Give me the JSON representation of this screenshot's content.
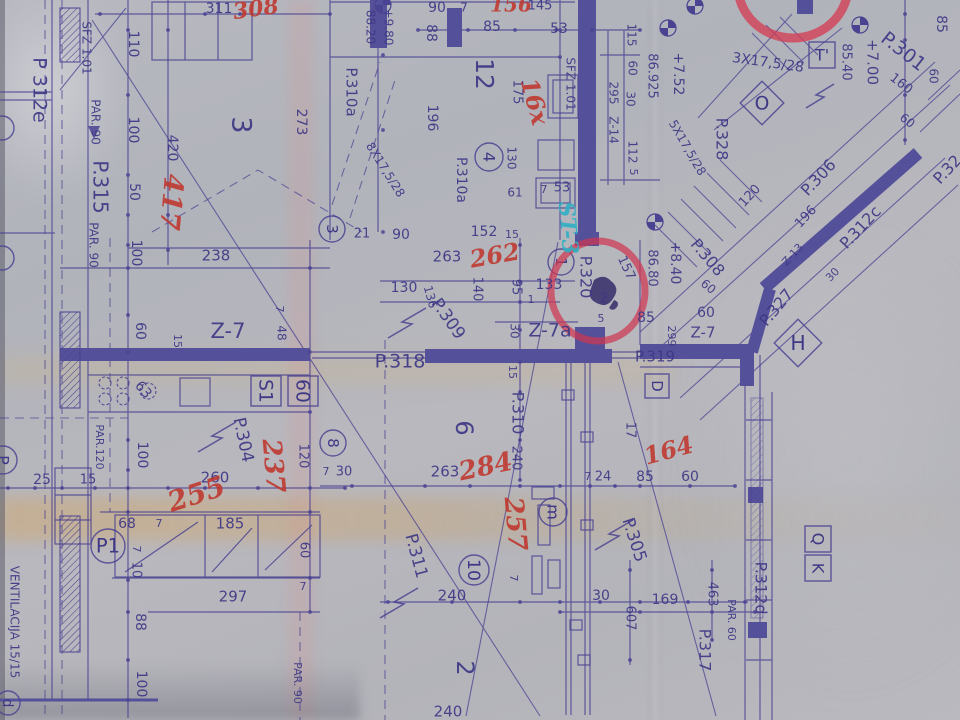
{
  "document": {
    "kind": "architectural floor plan blueprint (photograph)",
    "vent_note": "VENTILACIJA 15/15"
  },
  "colors": {
    "paper": "#b4b5bc",
    "ink": "#4a4392",
    "ink_text": "#3e3886",
    "wall": "#55509a",
    "red_note": "#bf3a31",
    "red_circle": "#cf3752",
    "teal_note": "#2fb0c4",
    "crease_tan": "#c9ab79"
  },
  "labels": [
    {
      "t": "311",
      "x": 219,
      "y": 9,
      "r": 0,
      "s": 14
    },
    {
      "t": "308",
      "x": 256,
      "y": 10,
      "r": -8,
      "s": 22,
      "c": "red",
      "k": "site-note-red"
    },
    {
      "t": "90",
      "x": 437,
      "y": 8,
      "r": 0,
      "s": 14
    },
    {
      "t": "7",
      "x": 464,
      "y": 8,
      "r": 0,
      "s": 12
    },
    {
      "t": "156",
      "x": 511,
      "y": 6,
      "r": 0,
      "s": 20,
      "c": "red",
      "k": "site-note-red"
    },
    {
      "t": "145",
      "x": 540,
      "y": 6,
      "r": 0,
      "s": 13
    },
    {
      "t": "85",
      "x": 492,
      "y": 27,
      "r": 0,
      "s": 14
    },
    {
      "t": "53",
      "x": 559,
      "y": 29,
      "r": 0,
      "s": 14
    },
    {
      "t": "88",
      "x": 431,
      "y": 33,
      "r": 90,
      "s": 14
    },
    {
      "t": "88.20",
      "x": 370,
      "y": 27,
      "r": 90,
      "s": 12
    },
    {
      "t": "+9.80",
      "x": 388,
      "y": 27,
      "r": 90,
      "s": 12
    },
    {
      "t": "110",
      "x": 133,
      "y": 44,
      "r": 90,
      "s": 14
    },
    {
      "t": "100",
      "x": 133,
      "y": 130,
      "r": 90,
      "s": 14
    },
    {
      "t": "50",
      "x": 134,
      "y": 192,
      "r": 90,
      "s": 14
    },
    {
      "t": "420",
      "x": 172,
      "y": 148,
      "r": 90,
      "s": 14
    },
    {
      "t": "417",
      "x": 170,
      "y": 202,
      "r": 95,
      "s": 27,
      "c": "red",
      "k": "site-note-red"
    },
    {
      "t": "SFZ 1.01",
      "x": 86,
      "y": 48,
      "r": 90,
      "s": 12,
      "k": "shaft-label"
    },
    {
      "t": "P 312e",
      "x": 39,
      "y": 90,
      "r": 90,
      "s": 19,
      "k": "door-label"
    },
    {
      "t": "PAR. 90",
      "x": 95,
      "y": 122,
      "r": 90,
      "s": 12,
      "k": "parapet-label"
    },
    {
      "t": "P.315",
      "x": 99,
      "y": 187,
      "r": 90,
      "s": 20,
      "k": "door-label"
    },
    {
      "t": "PAR. 90",
      "x": 93,
      "y": 245,
      "r": 90,
      "s": 12,
      "k": "parapet-label"
    },
    {
      "t": "3",
      "x": 240,
      "y": 125,
      "r": 90,
      "s": 27,
      "k": "room-number"
    },
    {
      "t": "273",
      "x": 301,
      "y": 122,
      "r": 90,
      "s": 14
    },
    {
      "t": "P.310a",
      "x": 351,
      "y": 92,
      "r": 90,
      "s": 15,
      "k": "door-label"
    },
    {
      "t": "12",
      "x": 483,
      "y": 74,
      "r": 90,
      "s": 25,
      "k": "room-number"
    },
    {
      "t": "175",
      "x": 517,
      "y": 92,
      "r": 90,
      "s": 13
    },
    {
      "t": "196",
      "x": 432,
      "y": 118,
      "r": 90,
      "s": 14
    },
    {
      "t": "16x",
      "x": 533,
      "y": 102,
      "r": 75,
      "s": 24,
      "c": "red",
      "k": "site-note-red"
    },
    {
      "t": "SFZ 1.01",
      "x": 570,
      "y": 84,
      "r": 90,
      "s": 12,
      "k": "shaft-label"
    },
    {
      "t": "115",
      "x": 631,
      "y": 35,
      "r": 90,
      "s": 12
    },
    {
      "t": "60",
      "x": 632,
      "y": 68,
      "r": 90,
      "s": 12
    },
    {
      "t": "295",
      "x": 613,
      "y": 93,
      "r": 90,
      "s": 12
    },
    {
      "t": "30",
      "x": 630,
      "y": 99,
      "r": 90,
      "s": 12
    },
    {
      "t": "Z-14",
      "x": 613,
      "y": 130,
      "r": 90,
      "s": 12,
      "k": "lintel-label"
    },
    {
      "t": "112",
      "x": 632,
      "y": 152,
      "r": 90,
      "s": 12
    },
    {
      "t": "5",
      "x": 633,
      "y": 172,
      "r": 90,
      "s": 11
    },
    {
      "t": "86.925",
      "x": 652,
      "y": 76,
      "r": 90,
      "s": 13,
      "k": "elevation"
    },
    {
      "t": "+7.52",
      "x": 678,
      "y": 74,
      "r": 90,
      "s": 14,
      "k": "elevation"
    },
    {
      "t": "85.40",
      "x": 846,
      "y": 62,
      "r": 90,
      "s": 13,
      "k": "elevation"
    },
    {
      "t": "+7.00",
      "x": 872,
      "y": 62,
      "r": 90,
      "s": 15,
      "k": "elevation"
    },
    {
      "t": "P.301",
      "x": 903,
      "y": 52,
      "r": 38,
      "s": 19,
      "k": "door-label"
    },
    {
      "t": "85",
      "x": 941,
      "y": 24,
      "r": 90,
      "s": 14
    },
    {
      "t": "160",
      "x": 901,
      "y": 84,
      "r": 38,
      "s": 13
    },
    {
      "t": "60",
      "x": 933,
      "y": 76,
      "r": 90,
      "s": 12
    },
    {
      "t": "60",
      "x": 907,
      "y": 121,
      "r": 38,
      "s": 12
    },
    {
      "t": "3X17,5/28",
      "x": 768,
      "y": 63,
      "r": 8,
      "s": 14,
      "k": "stair-label"
    },
    {
      "t": "P.328",
      "x": 721,
      "y": 139,
      "r": 90,
      "s": 16,
      "k": "door-label"
    },
    {
      "t": "5X17,5/28",
      "x": 687,
      "y": 148,
      "r": 60,
      "s": 12,
      "k": "stair-label"
    },
    {
      "t": "8X17,5/28",
      "x": 385,
      "y": 170,
      "r": 58,
      "s": 12,
      "k": "stair-label"
    },
    {
      "t": "120",
      "x": 750,
      "y": 196,
      "r": -47,
      "s": 13
    },
    {
      "t": "P.306",
      "x": 819,
      "y": 178,
      "r": -47,
      "s": 16,
      "k": "door-label"
    },
    {
      "t": "196",
      "x": 806,
      "y": 217,
      "r": -47,
      "s": 13
    },
    {
      "t": "P.312c",
      "x": 861,
      "y": 228,
      "r": -47,
      "s": 16,
      "k": "door-label"
    },
    {
      "t": "Z-13",
      "x": 793,
      "y": 255,
      "r": -47,
      "s": 11,
      "k": "lintel-label"
    },
    {
      "t": "30",
      "x": 833,
      "y": 275,
      "r": -47,
      "s": 11
    },
    {
      "t": "P.327",
      "x": 777,
      "y": 308,
      "r": -50,
      "s": 16,
      "k": "door-label"
    },
    {
      "t": "P.32",
      "x": 948,
      "y": 170,
      "r": -47,
      "s": 16,
      "k": "door-label"
    },
    {
      "t": "61",
      "x": 515,
      "y": 193,
      "r": 0,
      "s": 12
    },
    {
      "t": "7",
      "x": 544,
      "y": 190,
      "r": 0,
      "s": 11
    },
    {
      "t": "53",
      "x": 562,
      "y": 188,
      "r": 0,
      "s": 13
    },
    {
      "t": "130",
      "x": 511,
      "y": 158,
      "r": 90,
      "s": 12
    },
    {
      "t": "P.310a",
      "x": 461,
      "y": 180,
      "r": 90,
      "s": 14,
      "k": "door-label"
    },
    {
      "t": "21",
      "x": 362,
      "y": 234,
      "r": 0,
      "s": 13
    },
    {
      "t": "90",
      "x": 401,
      "y": 235,
      "r": 0,
      "s": 14
    },
    {
      "t": "152",
      "x": 484,
      "y": 232,
      "r": 0,
      "s": 14
    },
    {
      "t": "15",
      "x": 512,
      "y": 235,
      "r": 0,
      "s": 11
    },
    {
      "t": "238",
      "x": 216,
      "y": 256,
      "r": 0,
      "s": 15
    },
    {
      "t": "100",
      "x": 136,
      "y": 253,
      "r": 90,
      "s": 14
    },
    {
      "t": "60",
      "x": 140,
      "y": 331,
      "r": 90,
      "s": 14
    },
    {
      "t": "15",
      "x": 177,
      "y": 341,
      "r": 90,
      "s": 11
    },
    {
      "t": "Z-7",
      "x": 228,
      "y": 332,
      "r": 0,
      "s": 21,
      "k": "lintel-label"
    },
    {
      "t": "7",
      "x": 279,
      "y": 309,
      "r": 90,
      "s": 11
    },
    {
      "t": "48",
      "x": 281,
      "y": 333,
      "r": 90,
      "s": 12
    },
    {
      "t": "63",
      "x": 143,
      "y": 390,
      "r": 50,
      "s": 14
    },
    {
      "t": "263",
      "x": 447,
      "y": 257,
      "r": 0,
      "s": 15
    },
    {
      "t": "262",
      "x": 495,
      "y": 257,
      "r": -10,
      "s": 24,
      "c": "red",
      "k": "site-note-red"
    },
    {
      "t": "130",
      "x": 404,
      "y": 288,
      "r": 0,
      "s": 14
    },
    {
      "t": "136",
      "x": 430,
      "y": 297,
      "r": 75,
      "s": 12
    },
    {
      "t": "P.309",
      "x": 448,
      "y": 319,
      "r": 55,
      "s": 17,
      "k": "door-label"
    },
    {
      "t": "140",
      "x": 477,
      "y": 289,
      "r": 90,
      "s": 13
    },
    {
      "t": "95",
      "x": 516,
      "y": 287,
      "r": 90,
      "s": 13
    },
    {
      "t": "1",
      "x": 531,
      "y": 300,
      "r": 0,
      "s": 11
    },
    {
      "t": "133",
      "x": 549,
      "y": 285,
      "r": 0,
      "s": 14
    },
    {
      "t": "30",
      "x": 514,
      "y": 331,
      "r": 90,
      "s": 12
    },
    {
      "t": "Z-7a",
      "x": 550,
      "y": 331,
      "r": 0,
      "s": 19,
      "k": "lintel-label"
    },
    {
      "t": "P.318",
      "x": 400,
      "y": 362,
      "r": 0,
      "s": 19,
      "k": "door-label"
    },
    {
      "t": "P.320",
      "x": 585,
      "y": 277,
      "r": 90,
      "s": 16,
      "k": "door-label"
    },
    {
      "t": "157",
      "x": 626,
      "y": 268,
      "r": 65,
      "s": 13
    },
    {
      "t": "2",
      "x": 604,
      "y": 299,
      "r": 0,
      "s": 13
    },
    {
      "t": "5",
      "x": 601,
      "y": 319,
      "r": 0,
      "s": 11
    },
    {
      "t": "85",
      "x": 646,
      "y": 318,
      "r": 0,
      "s": 14
    },
    {
      "t": "86.80",
      "x": 652,
      "y": 268,
      "r": 90,
      "s": 13,
      "k": "elevation"
    },
    {
      "t": "+8.40",
      "x": 675,
      "y": 263,
      "r": 90,
      "s": 14,
      "k": "elevation"
    },
    {
      "t": "P.308",
      "x": 707,
      "y": 258,
      "r": 50,
      "s": 16,
      "k": "door-label"
    },
    {
      "t": "60",
      "x": 708,
      "y": 287,
      "r": 40,
      "s": 12
    },
    {
      "t": "60",
      "x": 706,
      "y": 313,
      "r": 0,
      "s": 14
    },
    {
      "t": "299",
      "x": 671,
      "y": 336,
      "r": 90,
      "s": 11
    },
    {
      "t": "Z-7",
      "x": 703,
      "y": 333,
      "r": 0,
      "s": 15,
      "k": "lintel-label"
    },
    {
      "t": "P.319",
      "x": 655,
      "y": 357,
      "r": 0,
      "s": 15,
      "k": "door-label"
    },
    {
      "t": "17",
      "x": 630,
      "y": 430,
      "r": 90,
      "s": 13
    },
    {
      "t": "164",
      "x": 669,
      "y": 452,
      "r": -15,
      "s": 24,
      "c": "red",
      "k": "site-note-red"
    },
    {
      "t": "15",
      "x": 512,
      "y": 372,
      "r": 90,
      "s": 11
    },
    {
      "t": "P.310",
      "x": 517,
      "y": 413,
      "r": 90,
      "s": 16,
      "k": "door-label"
    },
    {
      "t": "240",
      "x": 516,
      "y": 458,
      "r": 90,
      "s": 13
    },
    {
      "t": "6",
      "x": 463,
      "y": 428,
      "r": 90,
      "s": 24,
      "k": "room-number"
    },
    {
      "t": "7",
      "x": 326,
      "y": 472,
      "r": 0,
      "s": 11
    },
    {
      "t": "30",
      "x": 344,
      "y": 472,
      "r": 0,
      "s": 13
    },
    {
      "t": "263",
      "x": 445,
      "y": 472,
      "r": 0,
      "s": 15
    },
    {
      "t": "284",
      "x": 486,
      "y": 468,
      "r": -12,
      "s": 26,
      "c": "red",
      "k": "site-note-red"
    },
    {
      "t": "237",
      "x": 272,
      "y": 466,
      "r": 85,
      "s": 26,
      "c": "red",
      "k": "site-note-red"
    },
    {
      "t": "P.304",
      "x": 243,
      "y": 440,
      "r": 78,
      "s": 17,
      "k": "door-label"
    },
    {
      "t": "260",
      "x": 215,
      "y": 478,
      "r": 0,
      "s": 15
    },
    {
      "t": "255",
      "x": 197,
      "y": 496,
      "r": -18,
      "s": 28,
      "c": "red",
      "k": "site-note-red"
    },
    {
      "t": "120",
      "x": 303,
      "y": 456,
      "r": 90,
      "s": 13
    },
    {
      "t": "25",
      "x": 42,
      "y": 480,
      "r": 0,
      "s": 14
    },
    {
      "t": "15",
      "x": 88,
      "y": 480,
      "r": 0,
      "s": 13
    },
    {
      "t": "100",
      "x": 142,
      "y": 455,
      "r": 90,
      "s": 14
    },
    {
      "t": "PAR.120",
      "x": 99,
      "y": 447,
      "r": 90,
      "s": 11,
      "k": "parapet-label"
    },
    {
      "t": "68",
      "x": 127,
      "y": 524,
      "r": 0,
      "s": 14
    },
    {
      "t": "7",
      "x": 159,
      "y": 524,
      "r": 0,
      "s": 11
    },
    {
      "t": "7",
      "x": 136,
      "y": 549,
      "r": 90,
      "s": 11
    },
    {
      "t": "10",
      "x": 136,
      "y": 570,
      "r": 90,
      "s": 13
    },
    {
      "t": "185",
      "x": 230,
      "y": 524,
      "r": 0,
      "s": 15
    },
    {
      "t": "60",
      "x": 304,
      "y": 550,
      "r": 90,
      "s": 13
    },
    {
      "t": "7",
      "x": 303,
      "y": 587,
      "r": 0,
      "s": 11
    },
    {
      "t": "297",
      "x": 233,
      "y": 597,
      "r": 0,
      "s": 15
    },
    {
      "t": "88",
      "x": 140,
      "y": 622,
      "r": 90,
      "s": 14
    },
    {
      "t": "100",
      "x": 141,
      "y": 684,
      "r": 90,
      "s": 14
    },
    {
      "t": "PAR. 90",
      "x": 297,
      "y": 683,
      "r": 90,
      "s": 11,
      "k": "parapet-label"
    },
    {
      "t": "VENTILACIJA 15/15",
      "x": 14,
      "y": 622,
      "r": 90,
      "s": 12,
      "k": "vent-label"
    },
    {
      "t": "257",
      "x": 514,
      "y": 524,
      "r": 85,
      "s": 26,
      "c": "red",
      "k": "site-note-red"
    },
    {
      "t": "240",
      "x": 452,
      "y": 596,
      "r": 0,
      "s": 15
    },
    {
      "t": "P.311",
      "x": 416,
      "y": 556,
      "r": 75,
      "s": 17,
      "k": "door-label"
    },
    {
      "t": "2",
      "x": 464,
      "y": 668,
      "r": 90,
      "s": 24,
      "k": "room-number"
    },
    {
      "t": "240",
      "x": 448,
      "y": 712,
      "r": 0,
      "s": 15
    },
    {
      "t": "30",
      "x": 601,
      "y": 596,
      "r": 0,
      "s": 14
    },
    {
      "t": "607",
      "x": 630,
      "y": 618,
      "r": 90,
      "s": 13
    },
    {
      "t": "169",
      "x": 665,
      "y": 600,
      "r": 0,
      "s": 14
    },
    {
      "t": "463",
      "x": 712,
      "y": 594,
      "r": 90,
      "s": 13
    },
    {
      "t": "PAR. 60",
      "x": 731,
      "y": 620,
      "r": 90,
      "s": 11,
      "k": "parapet-label"
    },
    {
      "t": "P.312d",
      "x": 760,
      "y": 588,
      "r": 90,
      "s": 16,
      "k": "door-label"
    },
    {
      "t": "P.317",
      "x": 704,
      "y": 650,
      "r": 90,
      "s": 16,
      "k": "door-label"
    },
    {
      "t": "P.305",
      "x": 634,
      "y": 540,
      "r": 72,
      "s": 17,
      "k": "door-label"
    },
    {
      "t": "7",
      "x": 513,
      "y": 578,
      "r": 90,
      "s": 11
    },
    {
      "t": "7",
      "x": 588,
      "y": 477,
      "r": 0,
      "s": 11
    },
    {
      "t": "24",
      "x": 603,
      "y": 477,
      "r": 0,
      "s": 13
    },
    {
      "t": "85",
      "x": 645,
      "y": 477,
      "r": 0,
      "s": 14
    },
    {
      "t": "60",
      "x": 690,
      "y": 477,
      "r": 0,
      "s": 14
    },
    {
      "t": "ST-3",
      "x": 567,
      "y": 228,
      "r": 85,
      "s": 22,
      "c": "teal",
      "k": "site-note-teal"
    }
  ],
  "circled": [
    {
      "t": "3",
      "x": 332,
      "y": 229,
      "rad": 13,
      "r": 90
    },
    {
      "t": "4",
      "x": 489,
      "y": 157,
      "rad": 14,
      "r": 90
    },
    {
      "t": "1",
      "x": 561,
      "y": 262,
      "rad": 13,
      "r": 90
    },
    {
      "t": "8",
      "x": 333,
      "y": 443,
      "rad": 13,
      "r": 90
    },
    {
      "t": "10",
      "x": 474,
      "y": 570,
      "rad": 15,
      "r": 90
    },
    {
      "t": "m",
      "x": 553,
      "y": 512,
      "rad": 14,
      "r": 90
    },
    {
      "t": "P1",
      "x": 108,
      "y": 546,
      "rad": 17,
      "r": 0
    },
    {
      "t": "d",
      "x": 8,
      "y": 703,
      "rad": 12,
      "r": 90
    },
    {
      "t": "",
      "x": 2,
      "y": 128,
      "rad": 12,
      "r": 0
    },
    {
      "t": "",
      "x": 2,
      "y": 258,
      "rad": 12,
      "r": 0
    },
    {
      "t": "P",
      "x": 3,
      "y": 460,
      "rad": 14,
      "r": 90
    }
  ],
  "boxed": [
    {
      "t": "T'",
      "x": 822,
      "y": 55,
      "w": 26,
      "h": 26,
      "r": 0
    },
    {
      "t": "D",
      "x": 657,
      "y": 386,
      "w": 24,
      "h": 24,
      "r": 90
    },
    {
      "t": "S1",
      "x": 266,
      "y": 391,
      "w": 30,
      "h": 30,
      "r": 90
    },
    {
      "t": "60",
      "x": 303,
      "y": 391,
      "w": 30,
      "h": 30,
      "r": 90
    },
    {
      "t": "Q",
      "x": 818,
      "y": 539,
      "w": 26,
      "h": 26,
      "r": 90
    },
    {
      "t": "K",
      "x": 818,
      "y": 568,
      "w": 26,
      "h": 26,
      "r": 90
    }
  ],
  "diamond": [
    {
      "t": "O",
      "x": 762,
      "y": 103,
      "half": 22
    },
    {
      "t": "H",
      "x": 798,
      "y": 343,
      "half": 24
    }
  ],
  "red_circle_note": {
    "around": "P.320",
    "cx": 598,
    "cy": 291
  },
  "red_arc_top_right": {
    "cx": 793,
    "cy": -14
  }
}
